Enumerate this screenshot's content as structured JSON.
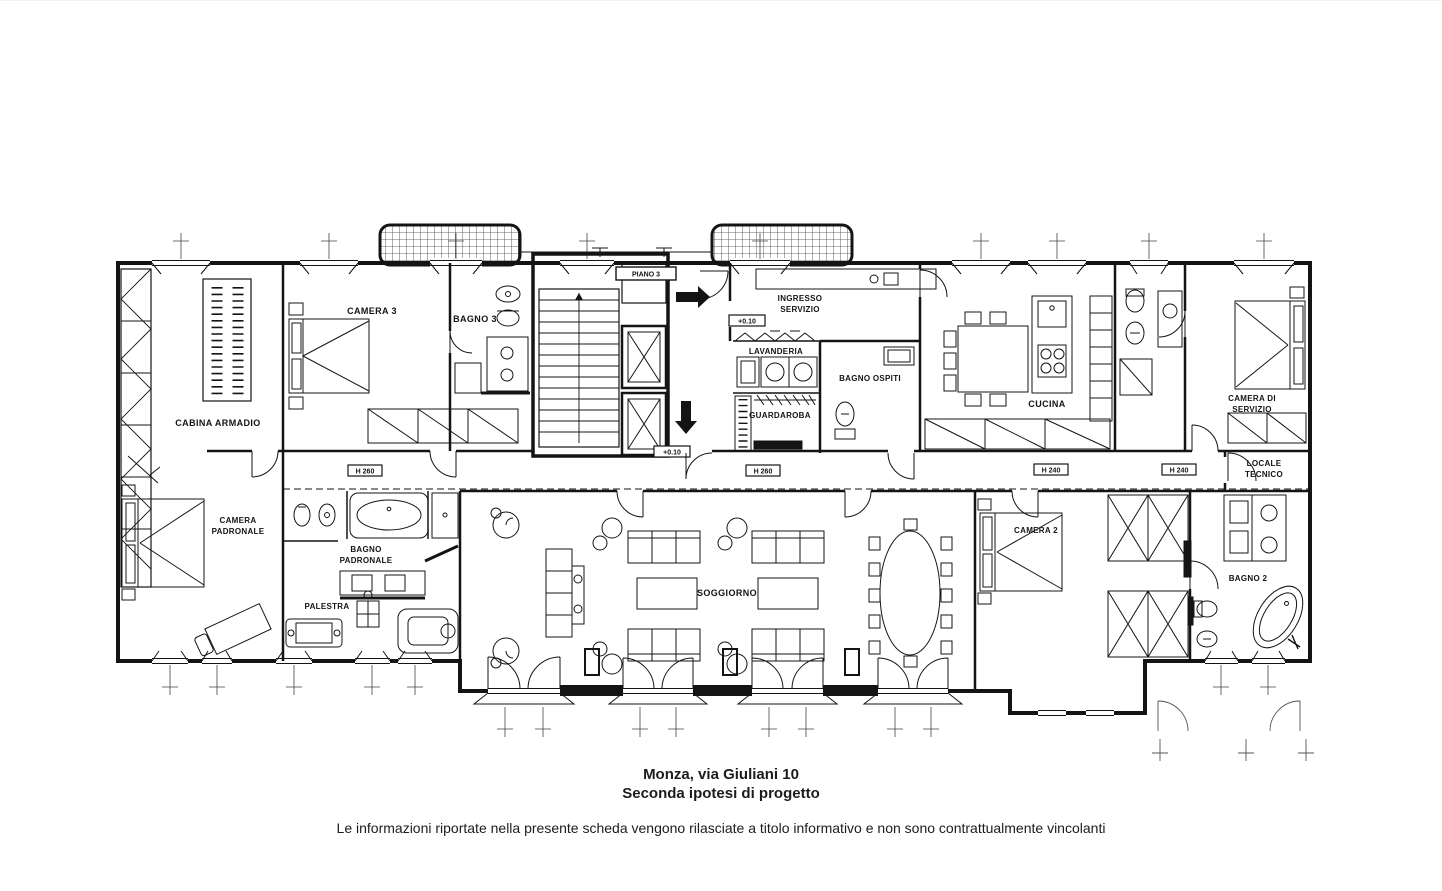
{
  "colors": {
    "line": "#141414",
    "background": "#ffffff"
  },
  "plan": {
    "markers": {
      "piano": "PIANO 3",
      "entry_level": "+0.10",
      "corridor_level": "+0.10",
      "h1": "H 260",
      "h2": "H 260",
      "h3": "H 240",
      "h4": "H 240"
    },
    "rooms": {
      "cabina_armadio": "CABINA ARMADIO",
      "camera3": "CAMERA 3",
      "bagno3": "BAGNO 3",
      "ingresso_line1": "INGRESSO",
      "ingresso_line2": "SERVIZIO",
      "lavanderia": "LAVANDERIA",
      "guardaroba": "GUARDAROBA",
      "bagno_ospiti": "BAGNO OSPITI",
      "cucina": "CUCINA",
      "camera_servizio_line1": "CAMERA DI",
      "camera_servizio_line2": "SERVIZIO",
      "locale_tecnico_line1": "LOCALE",
      "locale_tecnico_line2": "TECNICO",
      "camera_padronale_line1": "CAMERA",
      "camera_padronale_line2": "PADRONALE",
      "bagno_padronale_line1": "BAGNO",
      "bagno_padronale_line2": "PADRONALE",
      "palestra": "PALESTRA",
      "soggiorno": "SOGGIORNO",
      "camera2": "CAMERA 2",
      "bagno2": "BAGNO 2"
    }
  },
  "caption": {
    "line1": "Monza, via Giuliani 10",
    "line2": "Seconda ipotesi di progetto",
    "disclaimer": "Le informazioni riportate nella presente scheda vengono rilasciate a titolo informativo e non sono contrattualmente vincolanti"
  }
}
